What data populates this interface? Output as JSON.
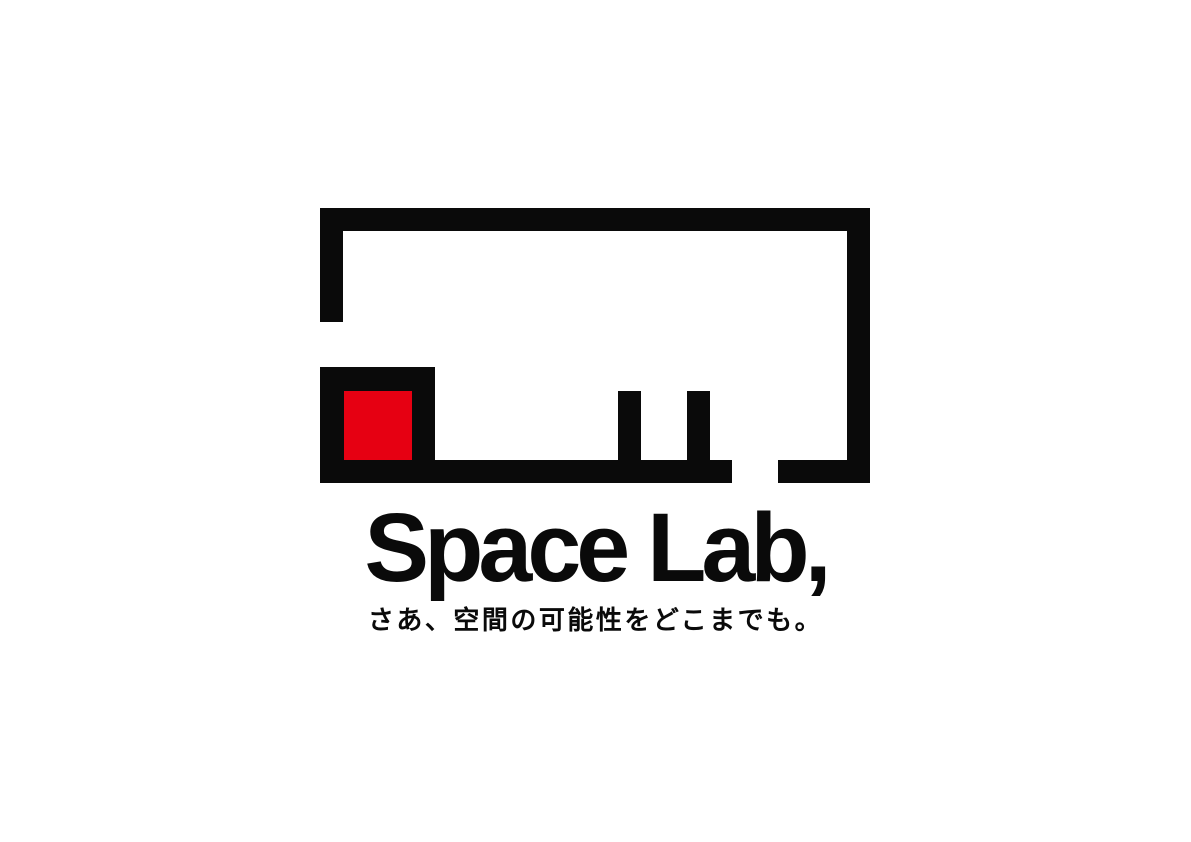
{
  "logo": {
    "wordmark": "Space Lab,",
    "tagline": "さあ、空間の可能性をどこまでも。",
    "colors": {
      "ink": "#0a0a0a",
      "accent": "#e60012",
      "background": "#ffffff"
    }
  }
}
